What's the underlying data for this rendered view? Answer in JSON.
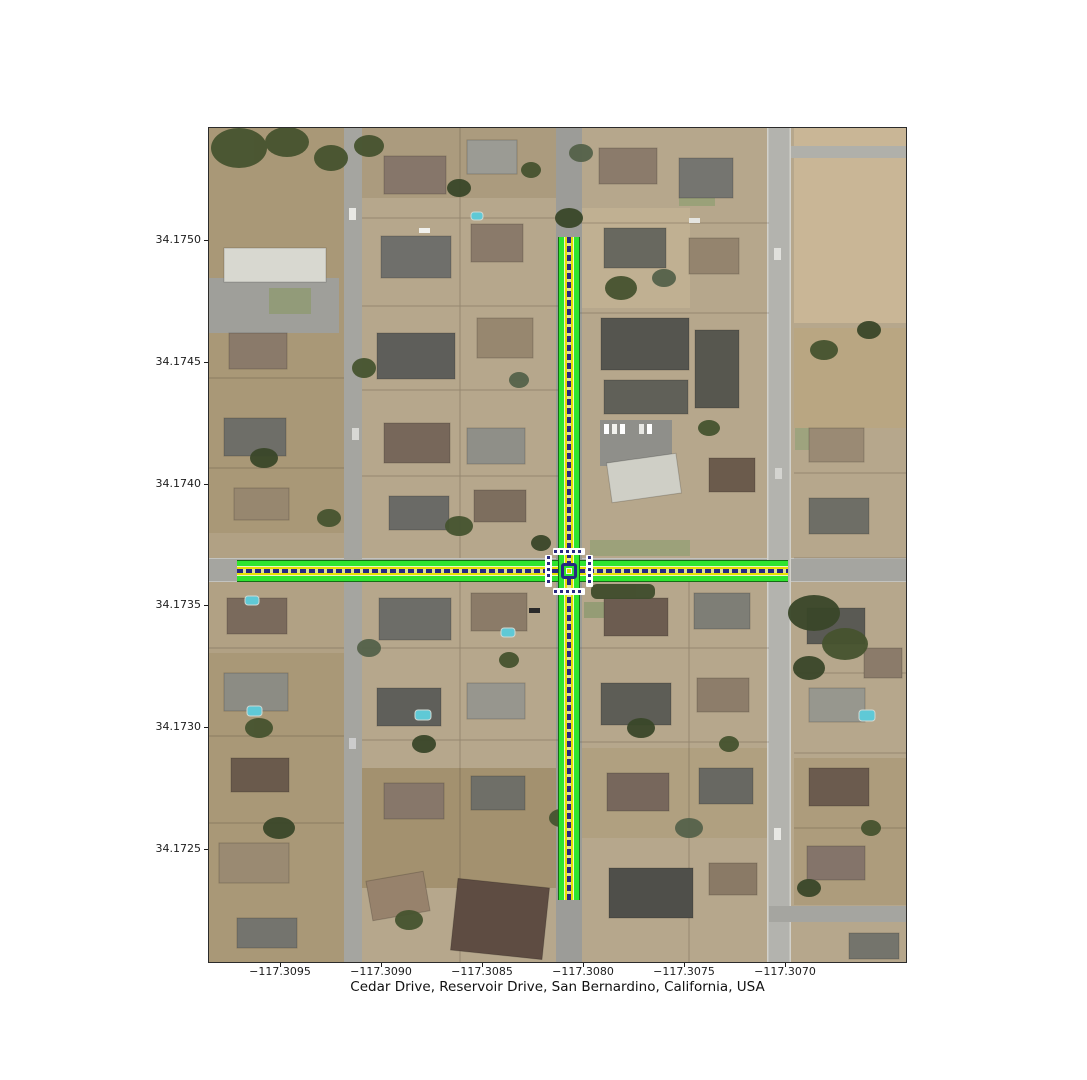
{
  "title": {
    "text": "Cedar Drive, Reservoir Drive, San Bernardino, California, USA"
  },
  "axes": {
    "x_tick_labels": [
      "−117.3095",
      "−117.3090",
      "−117.3085",
      "−117.3080",
      "−117.3075",
      "−117.3070"
    ],
    "y_tick_labels": [
      "34.1750",
      "34.1745",
      "34.1740",
      "34.1735",
      "34.1730",
      "34.1725"
    ]
  },
  "map": {
    "type": "aerial-imagery-with-lane-overlay",
    "highlighted_streets": [
      {
        "name": "Cedar Drive",
        "orientation": "vertical"
      },
      {
        "name": "Reservoir Drive",
        "orientation": "horizontal"
      }
    ],
    "overlay_colors": {
      "lane_fill_green": "#2fe42f",
      "lane_boundary_yellow": "#e8e000",
      "centerline_navy": "#282882",
      "centerline_dash": "#dede9a",
      "crosswalk": "#ffffff"
    }
  }
}
